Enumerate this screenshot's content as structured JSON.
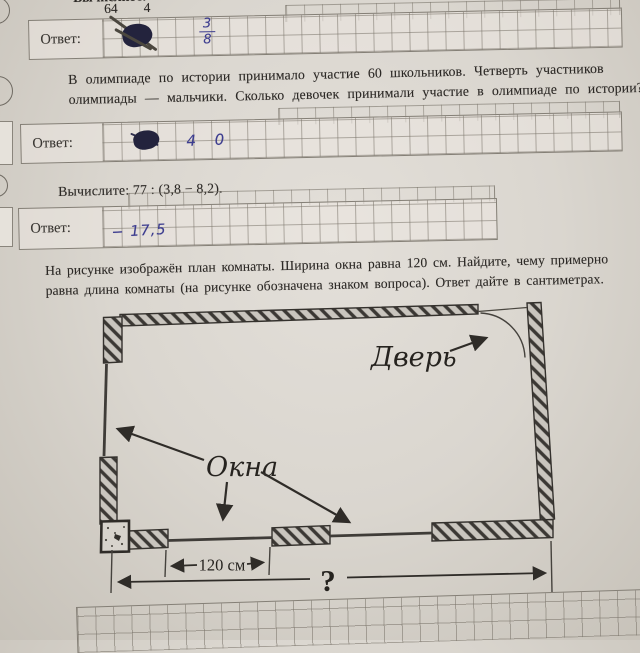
{
  "p1": {
    "prompt_fragment": "Вычислите:",
    "expression_denominator_1": "64",
    "expression_denominator_2": "4",
    "answer_label": "Ответ:",
    "handwritten": {
      "note": "crossed-out scribble",
      "fraction_numerator": "3",
      "fraction_denominator": "8"
    }
  },
  "p2": {
    "line1": "В олимпиаде по истории принимало участие 60 школьников. Четверть участников",
    "line2": "олимпиады — мальчики. Сколько девочек принимали участие в олимпиаде по истории?",
    "answer_label": "Ответ:",
    "handwritten": {
      "note": "crossed-out scribble",
      "final": "4 0"
    }
  },
  "p3": {
    "prompt": "Вычислите:  77 : (3,8 − 8,2).",
    "answer_label": "Ответ:",
    "handwritten": {
      "final": "− 17,5"
    }
  },
  "p4": {
    "line1": "На рисунке изображён план комнаты. Ширина окна равна 120 см. Найдите, чему примерно",
    "line2": "равна длина комнаты (на рисунке обозначена знаком вопроса). Ответ дайте в сантиметрах.",
    "diagram": {
      "door_label": "Дверь",
      "windows_label": "Окна",
      "window_width": "120 см",
      "room_length_unknown": "?"
    }
  },
  "colors": {
    "paper": "#dad6cf",
    "print_ink": "#2c2926",
    "pen_ink": "#3d3d8f",
    "grid_line": "#7a746a",
    "wall_hatch": "#3b3834"
  }
}
